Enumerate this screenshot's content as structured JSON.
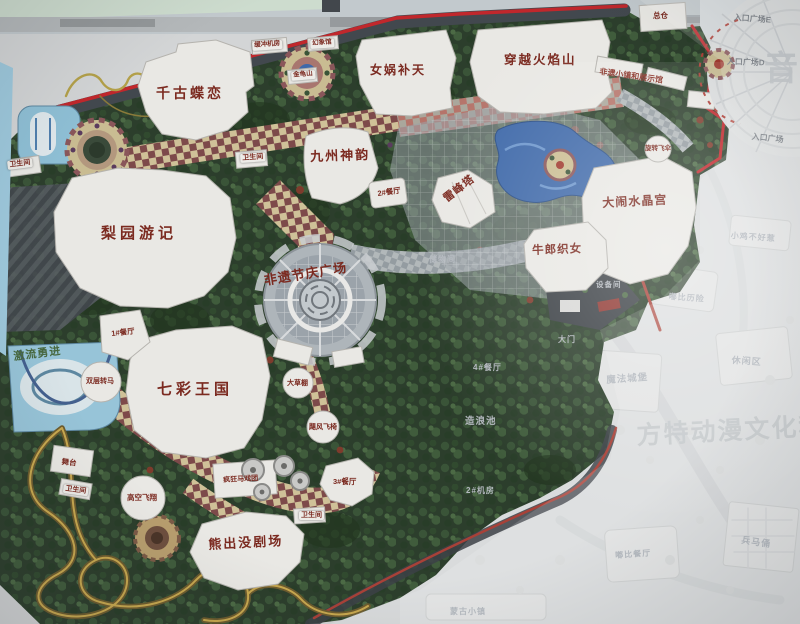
{
  "labels": {
    "attractions": [
      "千古蝶恋",
      "梨园游记",
      "九州神韵",
      "女娲补天",
      "穿越火焰山",
      "雷峰塔",
      "大闹水晶宫",
      "牛郎织女",
      "七彩王国",
      "熊出没剧场",
      "非遗节庆广场",
      "激流勇进",
      "总仓"
    ],
    "facilities": [
      "缓冲机房",
      "幻象馆",
      "金龟山",
      "卫生间",
      "卫生间",
      "2#餐厅",
      "1#餐厅",
      "双层转马",
      "大草棚",
      "飓风飞椅",
      "舞台",
      "卫生间",
      "高空飞翔",
      "疯狂马戏团",
      "3#餐厅",
      "卫生间",
      "旋转飞伞",
      "非遗小镇和展示馆"
    ],
    "entrance": [
      "入口广场E",
      "入口广场D",
      "入口广场"
    ],
    "ghost": [
      "储物间",
      "小鸡不好惹",
      "嘟比历险",
      "4#餐厅",
      "休闲区",
      "魔法城堡",
      "造浪池",
      "2#机房",
      "大门",
      "设备间",
      "兵马俑",
      "嘟比餐厅",
      "蒙古小镇"
    ],
    "watermarks": [
      "音",
      "方特动漫文化科技"
    ]
  },
  "colors": {
    "path_tan": "#cfc198",
    "path_maroon": "#7d4a4a",
    "foliage": "#2c3e2c",
    "water": "#3f69a9",
    "road_red": "#c1272c",
    "building_white": "#e9e8e4",
    "label_red": "#7b2a20"
  }
}
